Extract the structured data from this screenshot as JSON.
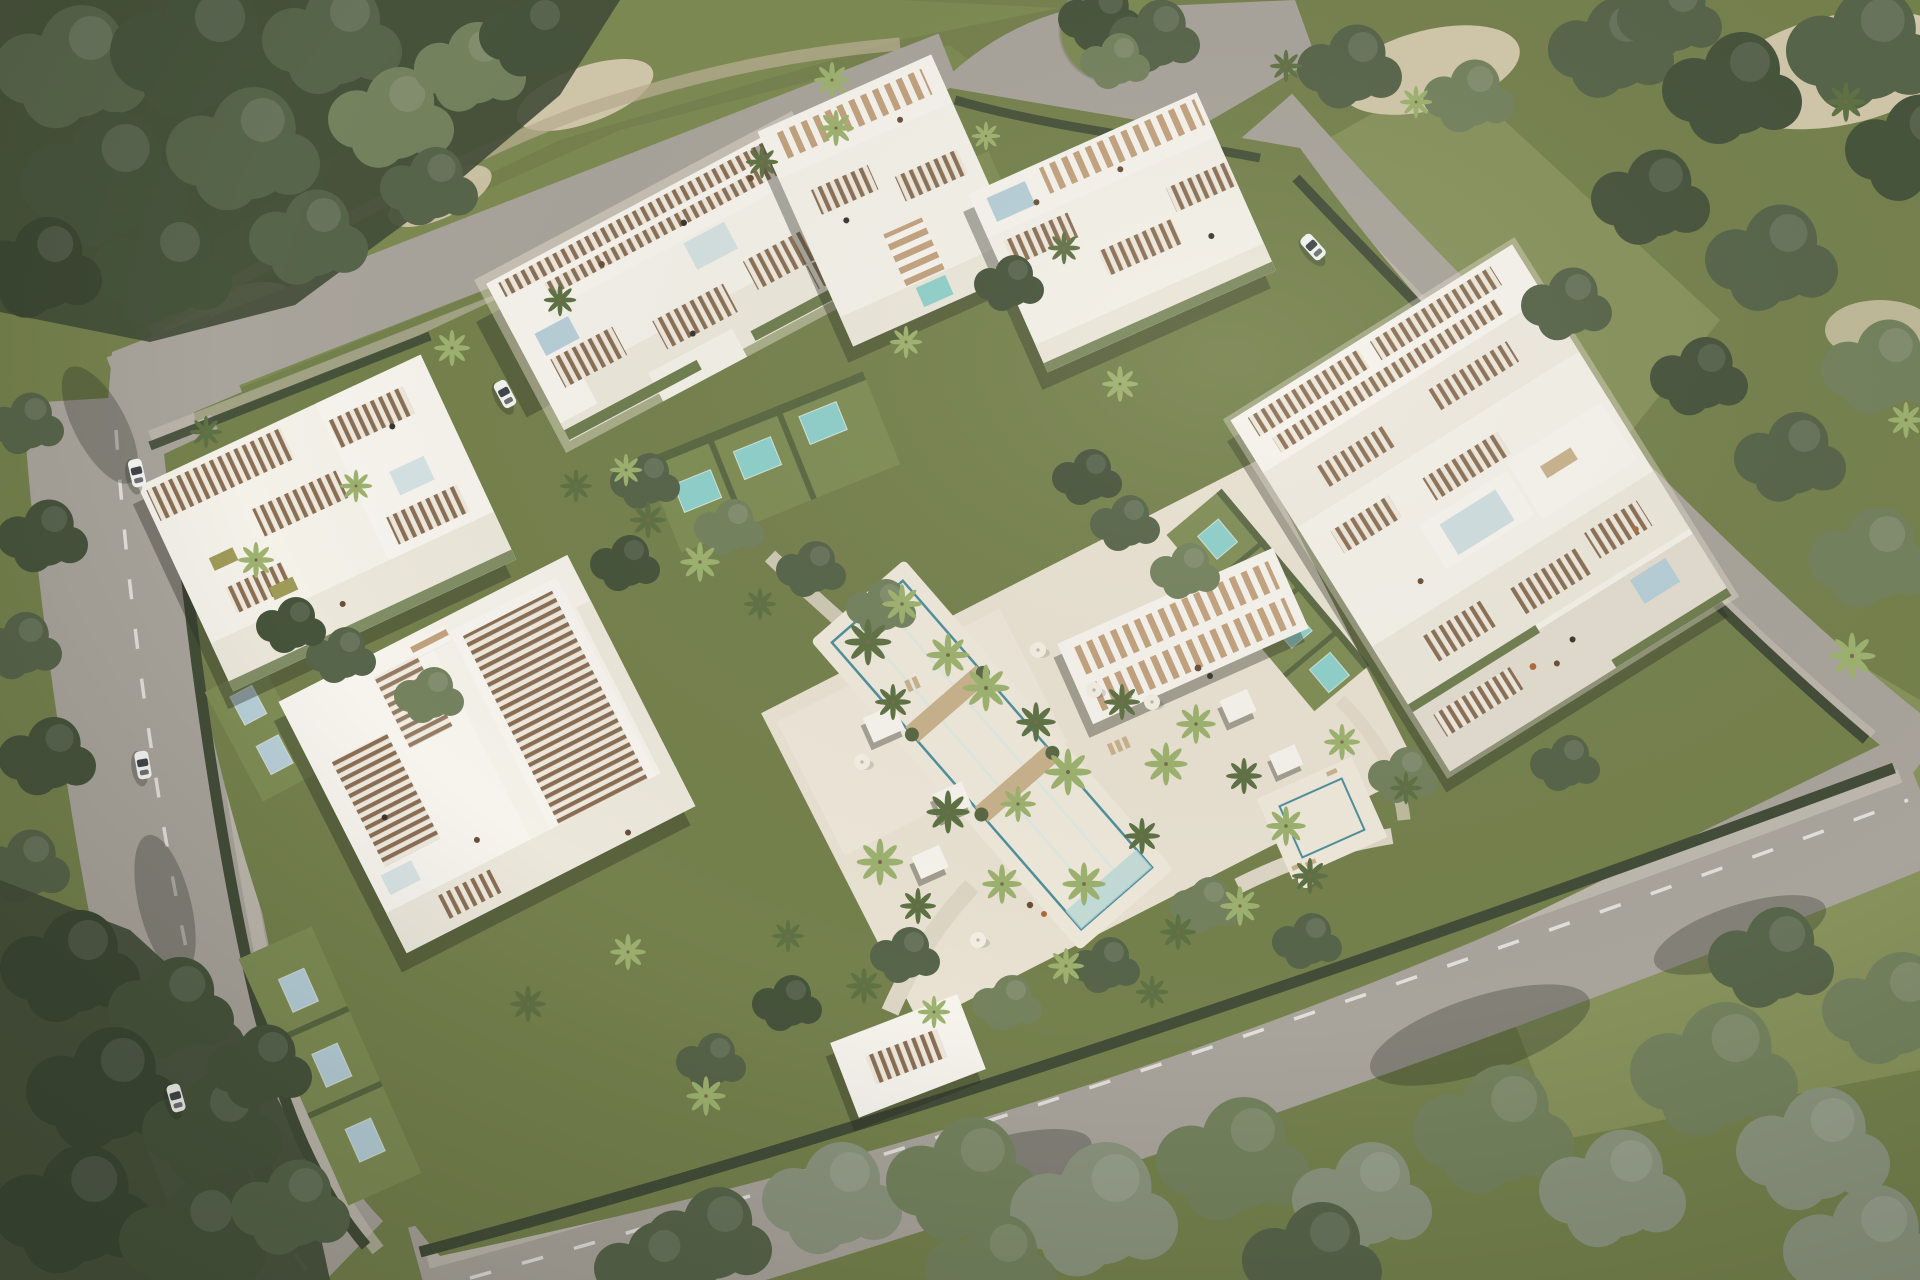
{
  "scene": {
    "title": "Aerial render of a modern white luxury apartment complex with central pool gardens",
    "description": "Bird's-eye architectural visualization: five terraced white apartment buildings with wooden pergola roofs and private plunge pools arranged around a landscaped amenity courtyard with a long turquoise swimming pool, palm trees, cabanas and a slatted sun deck. A perimeter road loop with dashed lane markings, a roundabout at top, white cars, sandy golf-course paths and dense green tree masses surround the walled compound.",
    "buildings": [
      {
        "id": "building-north",
        "label": "north apartment block with rooftop pergolas and roof pool"
      },
      {
        "id": "building-northeast-a",
        "label": "small northeast apartment block beside roundabout"
      },
      {
        "id": "building-northeast-b",
        "label": "second northeast apartment block with slatted roof deck"
      },
      {
        "id": "building-east",
        "label": "large east apartment block along right road"
      },
      {
        "id": "building-west",
        "label": "west apartment block along left road"
      },
      {
        "id": "building-southwest",
        "label": "southwest apartment block with large louvered pergola roof"
      }
    ],
    "amenities": [
      {
        "id": "main-pool",
        "label": "long turquoise resort pool with two timber crossing decks"
      },
      {
        "id": "secondary-pool",
        "label": "small square amenity pool on east deck"
      },
      {
        "id": "sun-deck-pergola",
        "label": "white slatted sun-deck pergola northeast of pool"
      },
      {
        "id": "entrance-gate",
        "label": "white slatted entrance gate canopy at south road"
      },
      {
        "id": "roundabout",
        "label": "roundabout with planted green island at top"
      },
      {
        "id": "plunge-pools",
        "label": "private plunge pools on ground-floor unit lawns",
        "count": 14
      }
    ],
    "vehicles": [
      {
        "id": "car-1",
        "label": "white car driving on left road (upper)"
      },
      {
        "id": "car-2",
        "label": "white car driving on left road (middle)"
      },
      {
        "id": "car-3",
        "label": "white car driving on left road (lower)"
      },
      {
        "id": "car-4",
        "label": "white car parked by north building apron"
      },
      {
        "id": "car-5",
        "label": "white car driving on right road"
      }
    ],
    "vegetation": {
      "tree-mass-top-left": "dense broadleaf forest corner",
      "tree-mass-bottom-left": "shaded forest corner",
      "tree-band-bottom": "large sunlit trees overhanging south road",
      "tree-mass-top-right": "forest with sandy clearings",
      "palms": "approx 50 palm trees through courtyard and streets",
      "fairways": "mown golf-style lawns with sand waste areas top-left and top-right"
    }
  },
  "palette": {
    "base": "#75814d",
    "fairway": "#7d8a52",
    "grass_light": "#87925c",
    "lawn": "#7f8d55",
    "tree_dark": "#47543c",
    "tree_mid": "#57654a",
    "tree_deep": "#3c4733",
    "tree_light": "#74825e",
    "tree_pale": "#8b947e",
    "palm_light": "#9db26f",
    "palm_dark": "#5f7244",
    "sand": "#d2c8ab",
    "sand_edge": "#b9ae91",
    "road": "#a9a49b",
    "road_light": "#b4afa5",
    "sidewalk": "#c6c0b5",
    "dash": "#eceae4",
    "hedge": "#434d38",
    "hedge_soft": "#5a6842",
    "bldg": "#f4f1e9",
    "bldg_hi": "#f7f4ee",
    "bldg_mid": "#ece7db",
    "bldg_low": "#e3ddd0",
    "bldg_shade": "#d6d0c3",
    "louver": "#8a6f55",
    "slat_cream": "#efe9dd",
    "step_tan": "#c2a27e",
    "planter": "#6f7e50",
    "olive": "#a09a58",
    "deck": "#e9e2d2",
    "deck_light": "#efe9db",
    "path": "#ded6c5",
    "wood": "#c9b28d",
    "water_hi": "#a7dad8",
    "water_lo": "#5fa3ae",
    "pool_edge": "#4e8f9c",
    "plunge": "#8fd0cb",
    "pool_pale": "#b7cfd8",
    "glass": "#cfdee0",
    "shadow": "rgba(45,48,38,0.38)",
    "road_shadow": "rgba(40,45,35,0.30)",
    "car": "#f4f4f1",
    "car_glass": "#41464a",
    "trunk": "#7a6a4f",
    "furn": "#6b4f38",
    "furn_dark": "#3a362f",
    "furn_orange": "#b06a3a"
  }
}
